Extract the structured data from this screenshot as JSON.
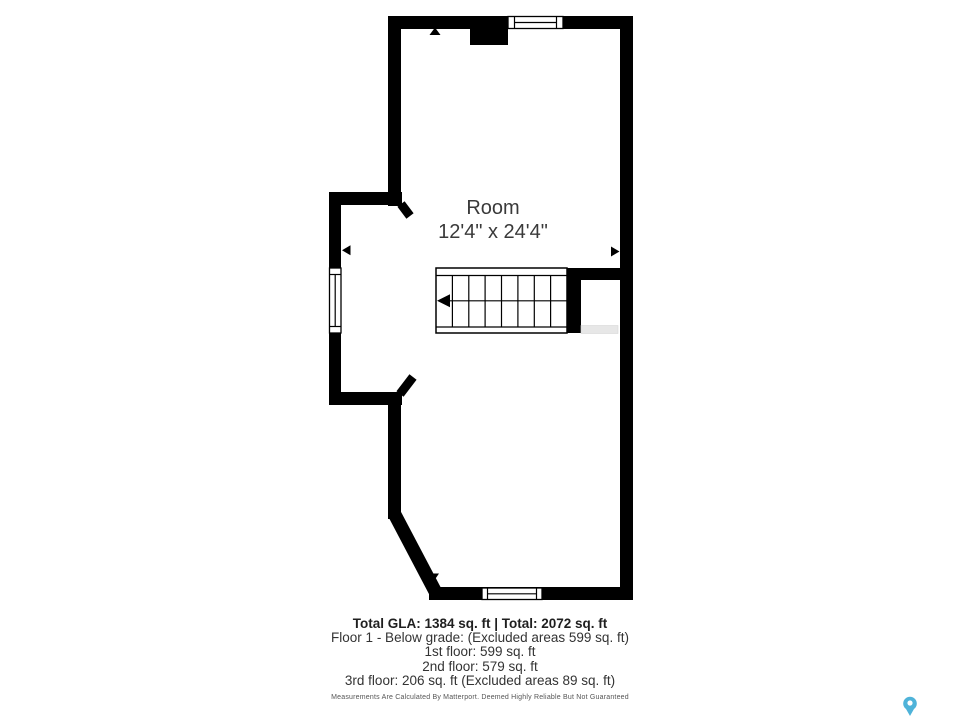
{
  "room": {
    "name": "Room",
    "dimensions": "12'4\" x 24'4\""
  },
  "footer": {
    "total_line": "Total GLA: 1384 sq. ft | Total: 2072 sq. ft",
    "floor1_line": "Floor 1 - Below grade: (Excluded areas 599 sq. ft)",
    "floor_1st_line": "1st floor: 599 sq. ft",
    "floor_2nd_line": "2nd floor: 579 sq. ft",
    "floor_3rd_line": "3rd floor: 206 sq. ft (Excluded areas 89 sq. ft)",
    "disclaimer": "Measurements Are Calculated By Matterport. Deemed Highly Reliable But Not Guaranteed"
  },
  "icons": {
    "map_pin": "matterport-pin-icon"
  },
  "colors": {
    "wall": "#000000",
    "background": "#ffffff",
    "text": "#3a3a3a",
    "half_wall": "#e7e7e7",
    "pin": "#4fb3d9"
  }
}
